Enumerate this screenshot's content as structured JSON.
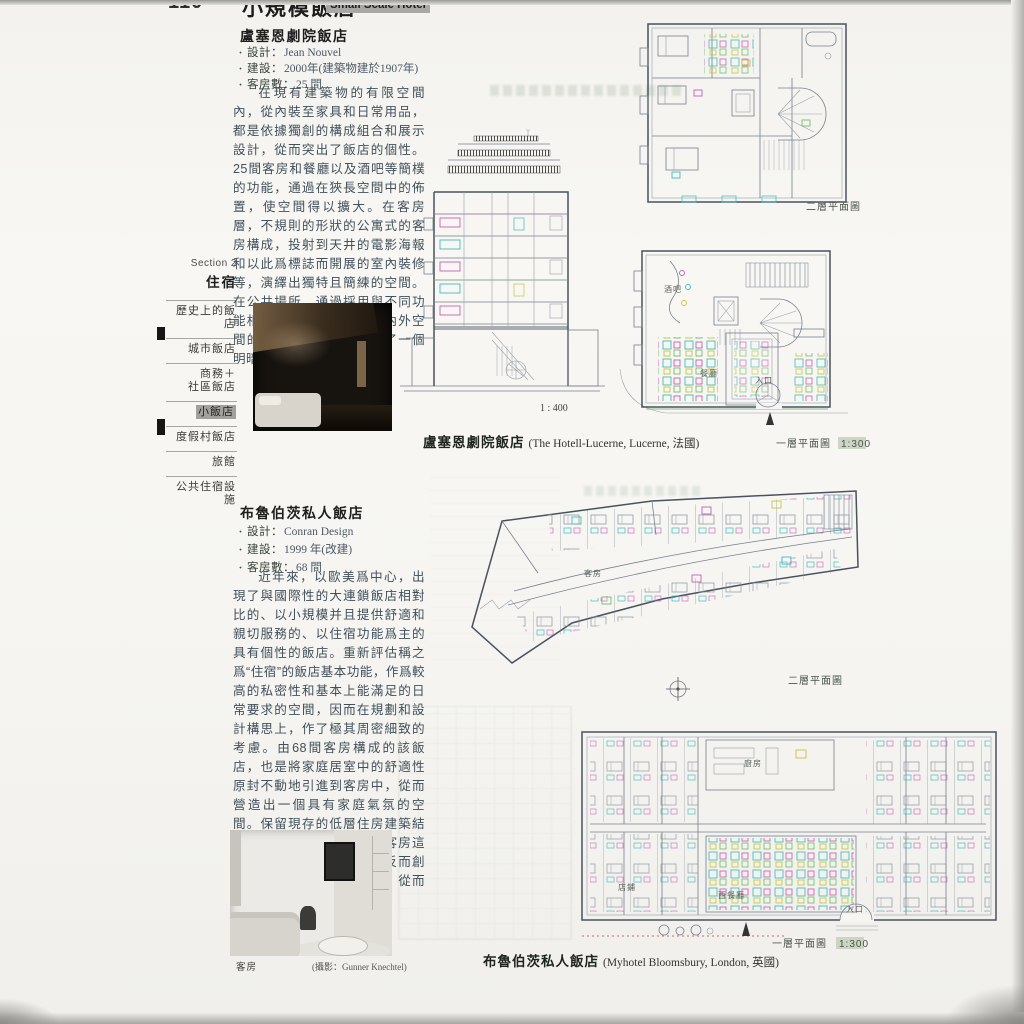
{
  "ui": {
    "bullet": "・"
  },
  "page": {
    "number": "110"
  },
  "header": {
    "title_zh": "小規模飯店",
    "title_en": "Small Scale Hotel"
  },
  "sidebar": {
    "section": "Section 2",
    "section_title": "住宿",
    "items": [
      {
        "label": "歷史上的飯店",
        "active": false
      },
      {
        "label": "城市飯店",
        "active": false
      },
      {
        "label": "商務＋",
        "label2": "社區飯店",
        "active": false
      },
      {
        "label": "小飯店",
        "active": true
      },
      {
        "label": "度假村飯店",
        "active": false
      },
      {
        "label": "旅館",
        "active": false
      },
      {
        "label": "公共住宿設施",
        "active": false
      }
    ]
  },
  "article1": {
    "title": "盧塞恩劇院飯店",
    "specs": [
      {
        "label": "設計：",
        "value": "Jean Nouvel"
      },
      {
        "label": "建設：",
        "value": "2000年(建築物建於1907年)"
      },
      {
        "label": "客房數：",
        "value": "25 間"
      }
    ],
    "body": "在現有建築物的有限空間內，從內裝至家具和日常用品，都是依據獨創的構成組合和展示設計，從而突出了飯店的個性。25間客房和餐廳以及酒吧等簡樸的功能，通過在狹長空間中的佈置，使空間得以擴大。在客房層，不規則的形狀的公寓式的客房構成，投射到天井的電影海報和以此爲標誌而開展的室內裝修等，演繹出獨特且簡練的空間。在公共場所，通過採用與不同功能相應的照度對比以及室內外空間的照明裝置，從而構成了一個明暗有序的空間。",
    "caption_zh": "盧塞恩劇院飯店",
    "caption_en": "(The Hotell-Lucerne, Lucerne, 法國)"
  },
  "article2": {
    "title": "布魯伯茨私人飯店",
    "specs": [
      {
        "label": "設計：",
        "value": "Conran Design"
      },
      {
        "label": "建設：",
        "value": "1999 年(改建)"
      },
      {
        "label": "客房數：",
        "value": "68 間"
      }
    ],
    "body": "近年來，以歐美爲中心，出現了與國際性的大連鎖飯店相對比的、以小規模并且提供舒適和親切服務的、以住宿功能爲主的具有個性的飯店。重新評估稱之爲“住宿”的飯店基本功能，作爲較高的私密性和基本上能滿足的日常要求的空間，因而在規劃和設計構思上，作了極其周密細致的考慮。由68間客房構成的該飯店，也是將家庭居室中的舒適性原封不動地引進到客房中，從而營造出一個具有家庭氣氛的空間。保留現存的低層住房建築結構形式，以及不具備標准客房這一概念的空間非均勻性，反而創造出風格各異的空間效果，從而產生出獨特的魅力。",
    "caption_zh": "布魯伯茨私人飯店",
    "caption_en": "(Myhotel Bloomsbury, London, 英國)",
    "photo_caption": "客房",
    "photo_credit": "(攝影：Gunner Knechtel)"
  },
  "drawings": {
    "section_scale": "1 : 400",
    "floor2_label": "二層平面圖",
    "floor1_label": "一層平面圖",
    "floor1_scale": "1:300",
    "labels": {
      "bar": "酒吧",
      "restaurant": "餐廳",
      "entrance": "入口",
      "guestroom": "客房",
      "kitchen": "廚房",
      "west_restaurant": "西餐廳",
      "shop": "店鋪"
    }
  },
  "colors": {
    "accent_cyan": "#3fbdbd",
    "accent_magenta": "#c75fb8",
    "accent_yellow": "#c9c53c",
    "accent_green": "#6fbf6f",
    "line": "#76818f",
    "wall": "#49525e"
  }
}
